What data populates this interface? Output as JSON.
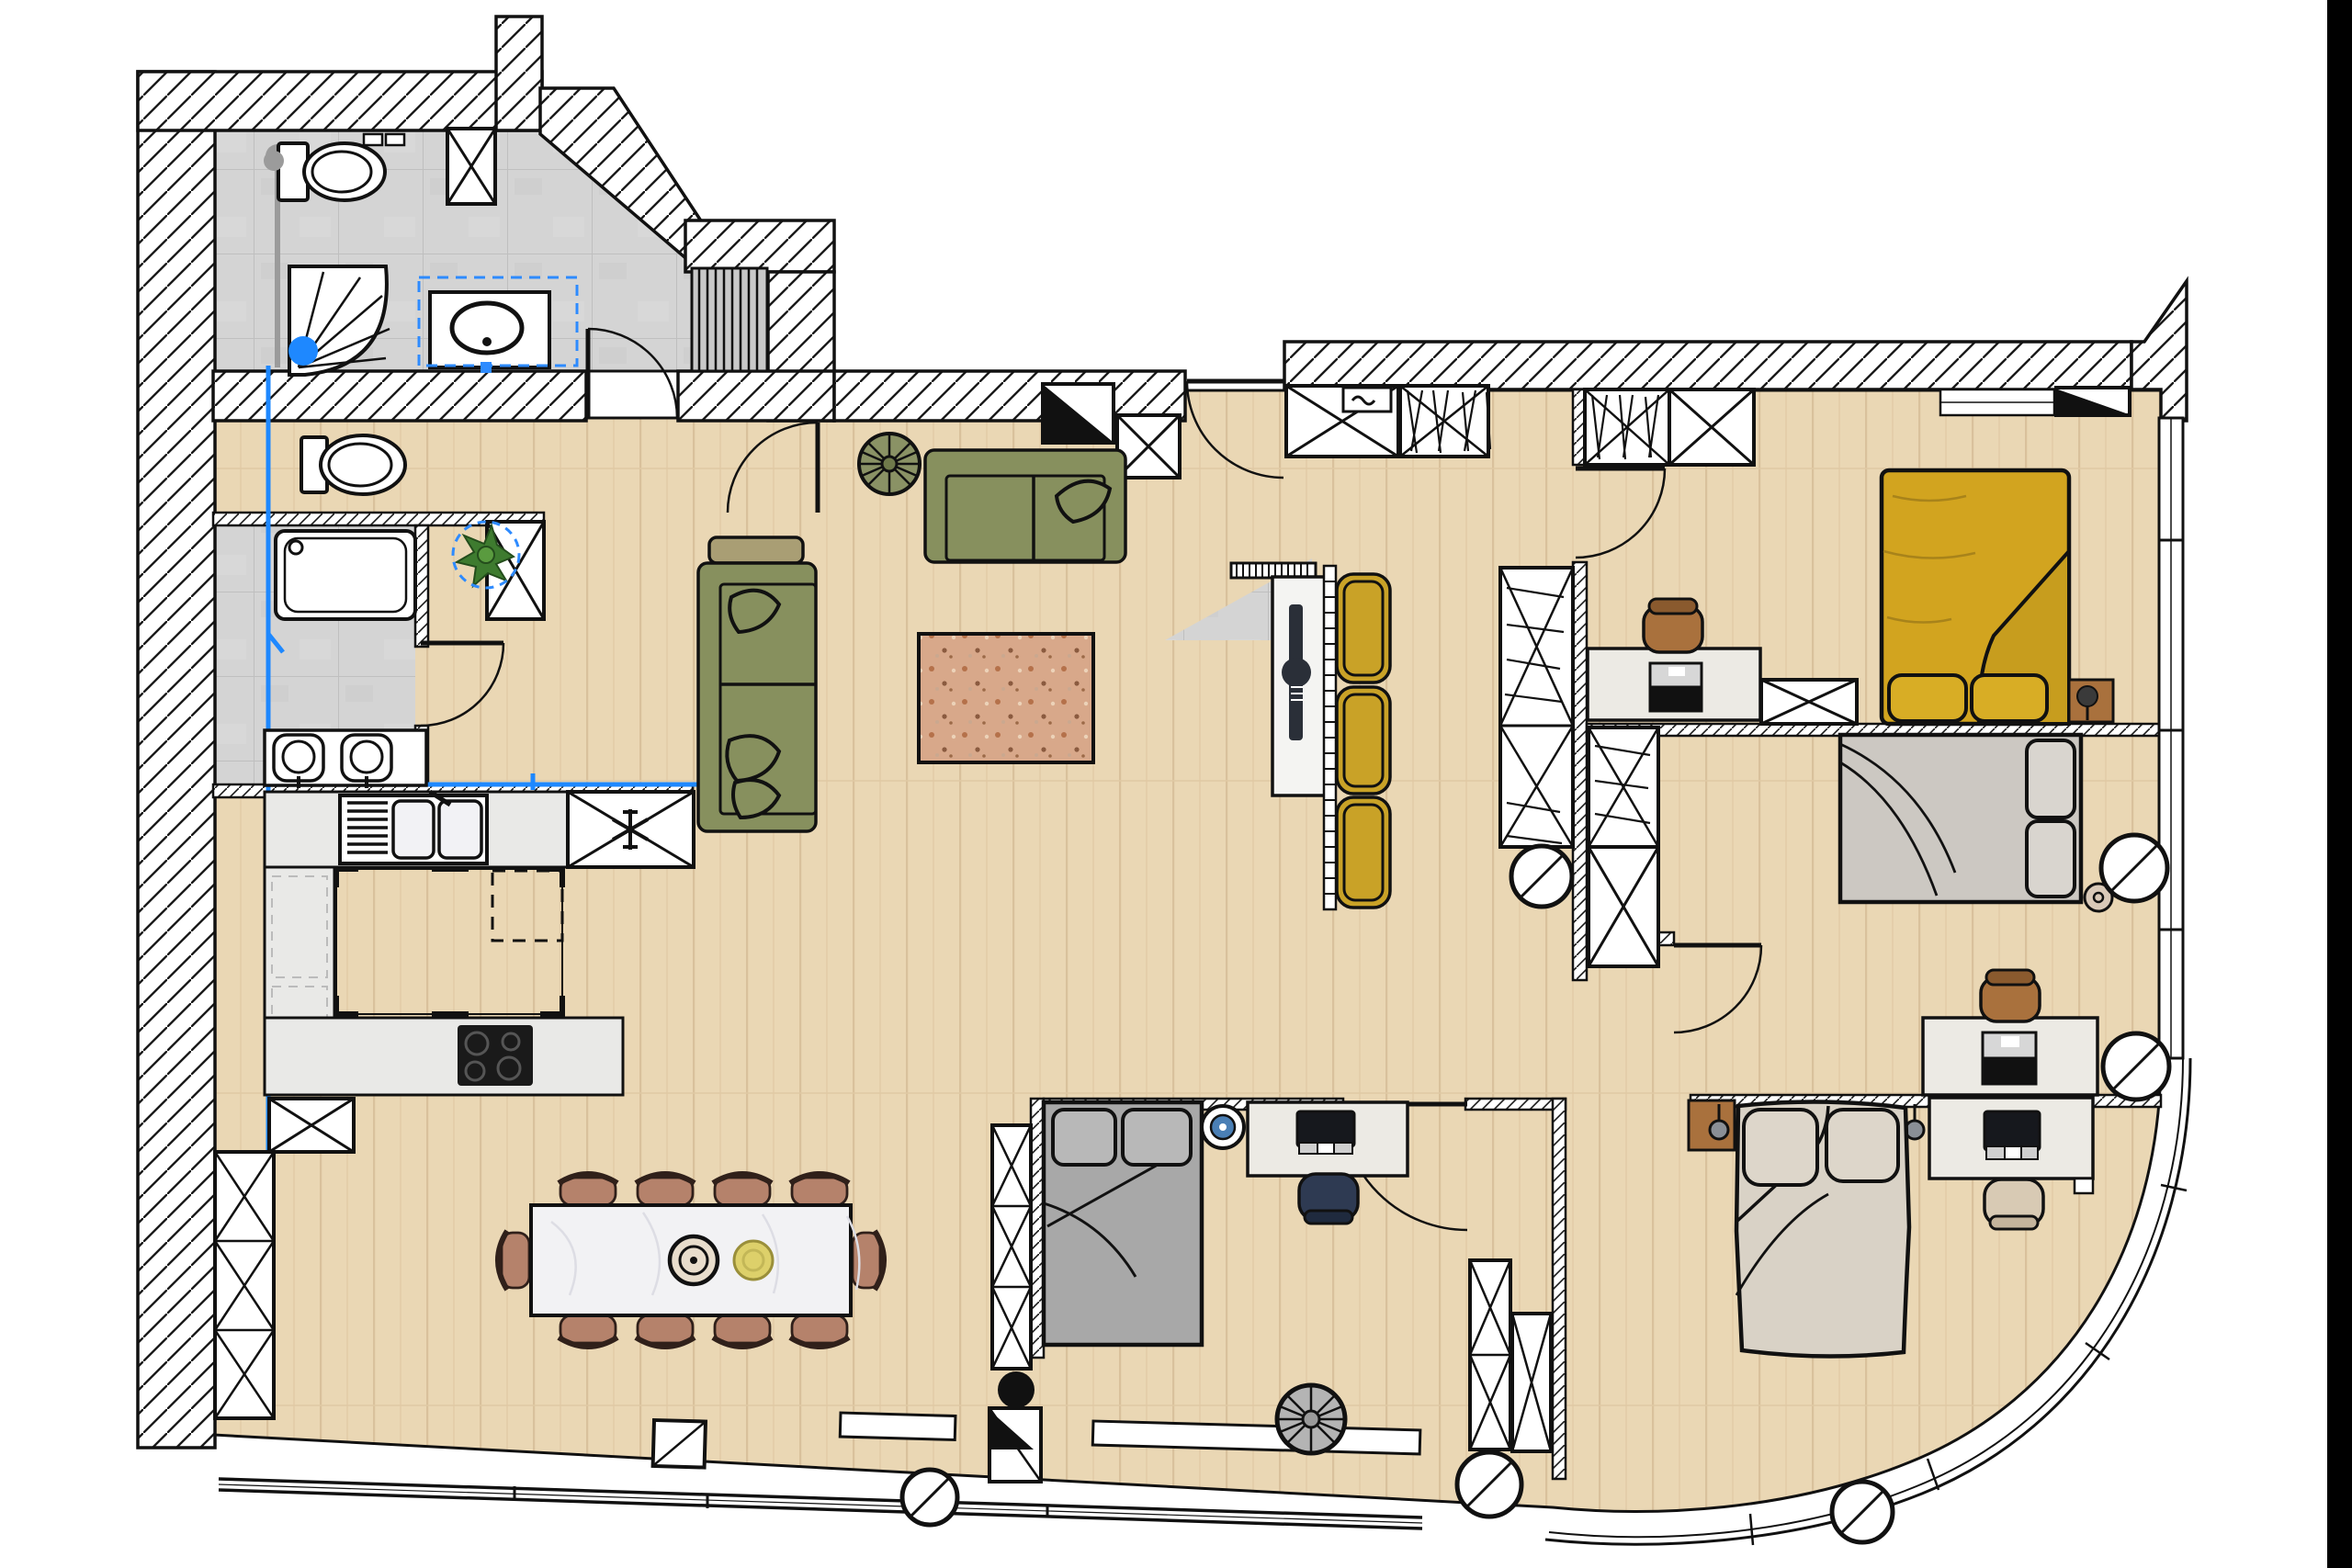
{
  "app": {
    "type": "floor-plan-editor-canvas",
    "view": "2d-top-down",
    "visible_text": []
  },
  "colors": {
    "outline": "#111111",
    "wall_fill": "#ffffff",
    "hatch_line": "#1a1a1a",
    "wood_base": "#ead7b4",
    "wood_grain": "#d9c19c",
    "tile_base": "#d4d4d4",
    "tile_line": "#bfbfbf",
    "tile_dark": "#c7c7c7",
    "rug_base": "#d8a88a",
    "rug_dot1": "#b5714a",
    "rug_dot2": "#8a5a3f",
    "rug_dot3": "#ecd2b8",
    "sofa": "#87905e",
    "sofa_line": "#111111",
    "ottoman": "#a99e74",
    "gold_chair": "#c9a227",
    "bed_master": "#d2a41f",
    "bed_master_fold": "#c79d1e",
    "bed_gray": "#ccc8c2",
    "bed_dark_gray": "#a8a8a8",
    "bed_beige": "#d9d2c6",
    "bed_beige_fold": "#cfc8bb",
    "pillow_yellow": "#d8ad25",
    "dining_chair": "#b5826b",
    "dining_table": "#f2f2f4",
    "plate_yellow": "#ddd06a",
    "desk": "#eceae4",
    "console": "#f4f4f2",
    "counter": "#e9e9e7",
    "chair_brown": "#a9713d",
    "chair_navy": "#2e3a52",
    "chair_beige": "#d8cab4",
    "nightstand": "#a9713d",
    "cooktop": "#1a1a1a",
    "tv": "#2a2f38",
    "monitor": "#16181d",
    "slats": "#c9c9c9",
    "fan_olive": "#8a9265",
    "spiral_gray": "#b4b4b4",
    "plant_green": "#3e7b2f",
    "plant_dark": "#244d1c",
    "accent_blue": "#2e8bff",
    "pipe_blue": "#1e88ff",
    "pipe_gray": "#9b9b9b",
    "black": "#111111",
    "edge_bar": "#000000"
  },
  "selection": {
    "selected_items": [
      "bathroom-sink-vanity",
      "potted-plant"
    ],
    "style": "blue-dashed-outline",
    "highlight_color": "#2e8bff"
  },
  "inventory": {
    "bathroom_top": [
      "toilet",
      "shower-quarter-round",
      "sink-vanity-selected",
      "storage-x-cabinet",
      "slatted-bench",
      "towel-rail",
      "floor-drain"
    ],
    "wc": [
      "toilet",
      "door"
    ],
    "bathroom_lower": [
      "bathtub",
      "double-sink-vanity",
      "washer-x-box"
    ],
    "kitchen": [
      "counter-top",
      "double-sink-with-drainer",
      "fridge-x-snowflake",
      "island-wood",
      "induction-cooktop",
      "dashed-appliance",
      "pantry-x-shelves"
    ],
    "living": [
      "sofa-horizontal",
      "sofa-vertical",
      "ottoman",
      "rug-speckled",
      "ceiling-fan-olive",
      "potted-plant-selected",
      "tv-console",
      "tv",
      "radiator",
      "gold-armchairs-x3",
      "ladder-strip"
    ],
    "dining": [
      "marble-table",
      "chairs-x10",
      "plate-decor-x2"
    ],
    "entry": [
      "entrance-door",
      "electrical-panel-triangle",
      "x-closet",
      "wardrobe-with-clothes",
      "safe-box"
    ],
    "bedroom_master": [
      "yellow-double-bed",
      "pillows-x2",
      "nightstand-lamp",
      "desk-laptop",
      "desk-chair",
      "wardrobe-with-clothes",
      "x-closet",
      "vent-triangle"
    ],
    "bedroom_middle": [
      "gray-double-bed",
      "pillows-x2",
      "round-side-table",
      "desk-laptop",
      "desk-chair",
      "wardrobe-with-clothes",
      "x-closet",
      "second-desk",
      "columns-x2"
    ],
    "bedroom_bottom_center": [
      "dark-gray-double-bed",
      "pillows-x2",
      "blue-round-table",
      "desk-monitor",
      "navy-chair",
      "tall-x-wardrobe",
      "x-closets",
      "spiral-stair-gray",
      "stove-black-circle",
      "vent-triangle-box"
    ],
    "bedroom_bottom_right": [
      "beige-double-bed",
      "pillows-x2",
      "pendant-lamps-x2",
      "nightstand",
      "desk-monitor-keyboard",
      "beige-chair"
    ],
    "structure": [
      "hatched-walls",
      "curved-glass-facade",
      "window-bands",
      "round-columns-x6",
      "blue-plumbing-lines"
    ]
  },
  "counts": {
    "columns": 6,
    "dining_chairs": 10,
    "gold_armchairs": 3,
    "beds": 4,
    "desks": 5,
    "toilets": 2,
    "doors": 8
  }
}
